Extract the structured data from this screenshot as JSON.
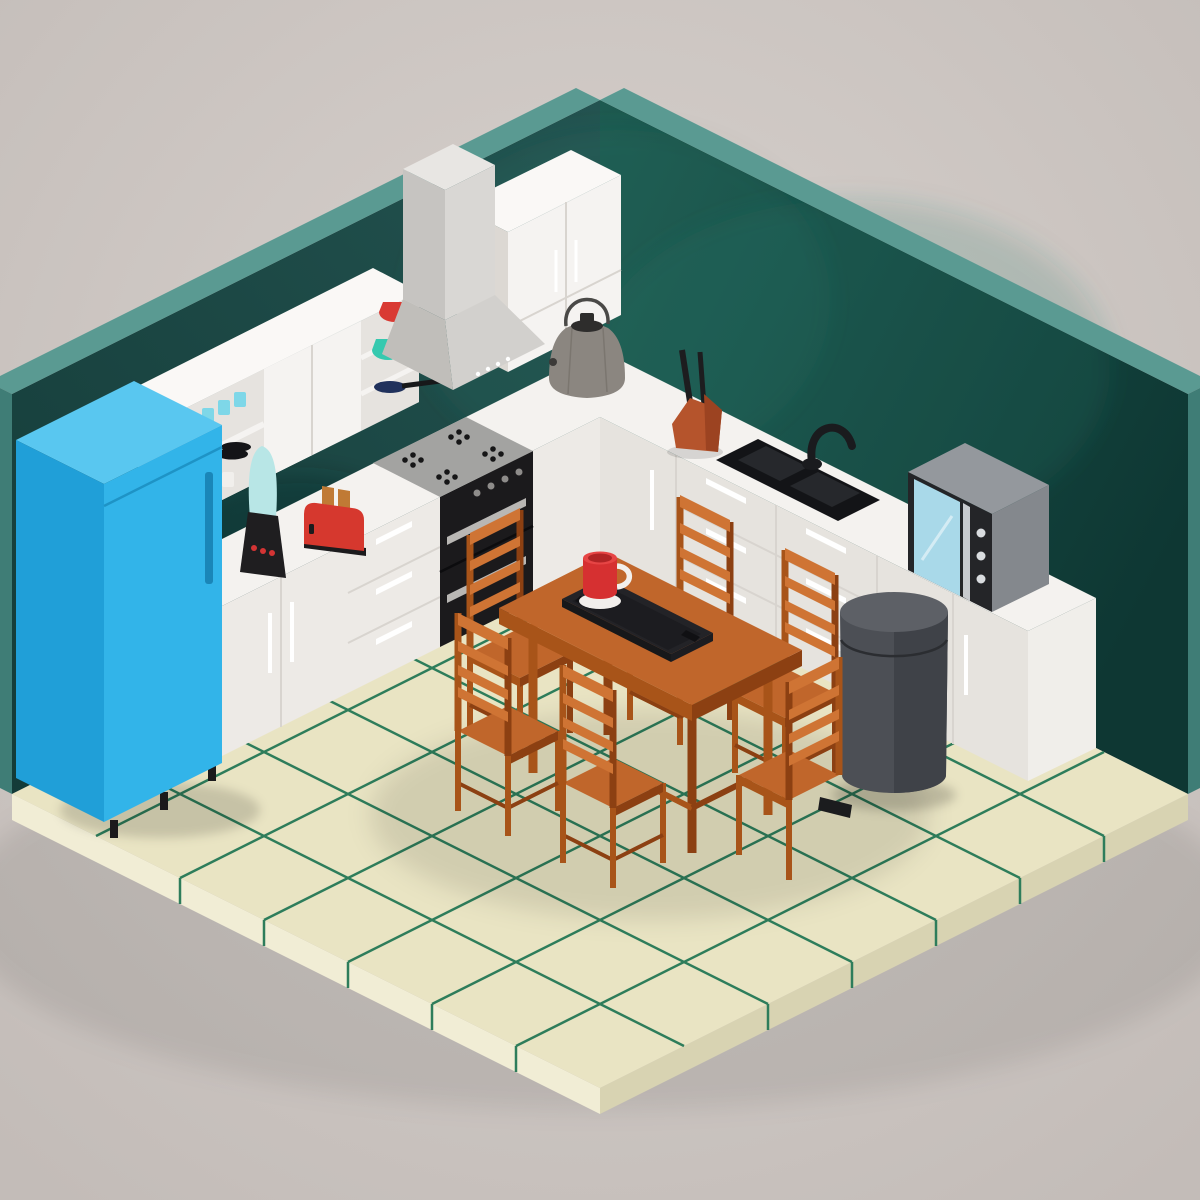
{
  "scene": {
    "title": "Low-poly isometric kitchen 3D render",
    "style": "Isometric room with two dark teal walls, cream tiled floor with green grout, white L-shaped kitchen counters and a wooden dining set",
    "objects": [
      {
        "id": "room",
        "label": "Room shell",
        "desc": "two dark teal walls with light teal edge strips, cream tile floor slab"
      },
      {
        "id": "fridge",
        "label": "Refrigerator",
        "desc": "blue single-door fridge with handle and black feet"
      },
      {
        "id": "wall-shelf",
        "label": "Wall shelf unit",
        "desc": "white shelf with cyan cups, black plates, white cups, red bowl, teal bowl, purple bowl, frying pan"
      },
      {
        "id": "upper-cabinet",
        "label": "Upper wall cabinet",
        "desc": "white double-door cabinet near corner"
      },
      {
        "id": "range-hood",
        "label": "Range hood",
        "desc": "light gray chimney hood over cooktop"
      },
      {
        "id": "cooktop",
        "label": "Gas cooktop",
        "desc": "gray top with four black burners"
      },
      {
        "id": "oven",
        "label": "Double oven",
        "desc": "black front, two handles, four knobs"
      },
      {
        "id": "base-cabinets",
        "label": "Base cabinets",
        "desc": "white L-shaped counter with doors and drawer banks"
      },
      {
        "id": "blender",
        "label": "Blender",
        "desc": "black base with red buttons, pale cyan jar"
      },
      {
        "id": "toaster",
        "label": "Toaster",
        "desc": "red body, black base, two toast slices"
      },
      {
        "id": "kettle",
        "label": "Kettle",
        "desc": "gray body, black lid, wire handle"
      },
      {
        "id": "knife-block",
        "label": "Knife block",
        "desc": "terracotta wedge with two black knives"
      },
      {
        "id": "sink",
        "label": "Kitchen sink",
        "desc": "black double basin with black arched faucet"
      },
      {
        "id": "microwave",
        "label": "Microwave",
        "desc": "gray body, black front, light blue window, three buttons"
      },
      {
        "id": "trash-can",
        "label": "Pedal bin",
        "desc": "dark gray cylinder with black pedal"
      },
      {
        "id": "dining-table",
        "label": "Dining table",
        "desc": "orange-brown wood rectangular table"
      },
      {
        "id": "chairs",
        "label": "Dining chairs",
        "count": 6,
        "desc": "ladder-back wooden chairs around table"
      },
      {
        "id": "tray",
        "label": "Serving tray",
        "desc": "black tray with handle slots"
      },
      {
        "id": "mug",
        "label": "Mug with saucer",
        "desc": "red mug, white handle and saucer"
      }
    ]
  },
  "palette": {
    "bg_light": "#d8d2ce",
    "bg_dark": "#c3bcb8",
    "wall_left_a": "#235350",
    "wall_left_b": "#143b38",
    "wall_right_a": "#1d5a50",
    "wall_right_b": "#0e3733",
    "wall_edge": "#5a9a92",
    "wall_edge_dark": "#3f7d76",
    "floor_tile": "#e9e4c3",
    "floor_grout": "#2e7d5b",
    "floor_side_l": "#f1edd5",
    "floor_side_r": "#d8d3b2",
    "counter_top": "#f4f2ef",
    "counter_front": "#edeae6",
    "counter_front_r": "#e6e3de",
    "counter_side": "#dcd8d3",
    "counter_side_r": "#f0eeea",
    "seam": "#d8d4cf",
    "handle_white": "#ffffff",
    "fridge_top": "#59c7f0",
    "fridge_front": "#32b4e9",
    "fridge_side": "#209fd8",
    "fridge_handle": "#1a86b8",
    "fridge_seam": "#1e93c6",
    "oven_black": "#1b1a1c",
    "oven_handle": "#b9b7b4",
    "oven_seam": "#0c0c0e",
    "knob_gray": "#8e8c8a",
    "cooktop_gray": "#a3a3a1",
    "burner_black": "#161617",
    "hood_front": "#d9d7d4",
    "hood_side": "#c6c4c1",
    "hood_top": "#e8e6e3",
    "hood_front2": "#d2d0cd",
    "hood_side2": "#c0beba",
    "shelf_white": "#f5f3f1",
    "shelf_inner": "#e6e3df",
    "shelf_side": "#dcd8d3",
    "shelf_top": "#faf8f6",
    "cup_cyan": "#7ed7e8",
    "cup_white": "#f1efec",
    "plate_black": "#141417",
    "bowl_red": "#d93a33",
    "bowl_teal": "#36c9af",
    "bowl_purple": "#5a31d0",
    "pan_blue": "#20315c",
    "pan_black": "#17181a",
    "blender_base": "#1f1e20",
    "blender_btn": "#d43434",
    "blender_jar": "#b8e6e6",
    "toaster_red": "#d6382e",
    "toaster_base": "#1c1b1d",
    "toast": "#c07a35",
    "kettle_body": "#8b8680",
    "kettle_facet": "#7b766f",
    "kettle_lid": "#2e2d2c",
    "kettle_handle": "#4a4947",
    "knife_block": "#b5542c",
    "knife_block_dark": "#9c4321",
    "knife_handle": "#1d1d1f",
    "sink_black": "#131417",
    "sink_basin": "#26282c",
    "faucet": "#1a1b1e",
    "micro_top": "#94989d",
    "micro_side": "#84888d",
    "micro_front": "#242528",
    "micro_screen": "#a9d9e9",
    "micro_btn": "#d9dcdf",
    "micro_handle": "#c7cace",
    "trash_body": "#4c4f55",
    "trash_body_dark": "#3f4248",
    "trash_top": "#5d6066",
    "trash_seam": "#2b2d31",
    "trash_pedal": "#1b1c1e",
    "wood_top": "#c0662b",
    "wood_light": "#cf7434",
    "wood_mid": "#a85419",
    "wood_dark": "#8c4012",
    "tray_body": "#232327",
    "tray_inner": "#1c1c20",
    "tray_slot": "#101013",
    "mug_red": "#d63031",
    "mug_red_dark": "#b02425",
    "mug_top": "#e64545",
    "saucer": "#f2efec",
    "shadow": "#000000",
    "wall_glow": "#2c7a6b"
  }
}
